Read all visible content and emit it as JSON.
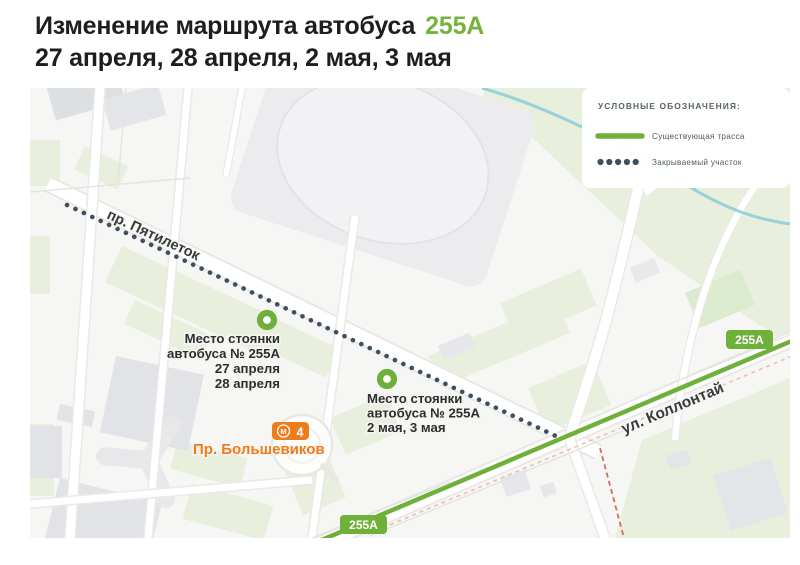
{
  "header": {
    "title_prefix": "Изменение маршрута автобуса",
    "title_route": "255А",
    "title_dates": "27 апреля, 28 апреля, 2 мая, 3 мая",
    "route_color": "#75b43c"
  },
  "legend": {
    "title": "УСЛОВНЫЕ ОБОЗНАЧЕНИЯ:",
    "items": [
      {
        "label": "Существующая трасса",
        "swatch": "solid-green-line",
        "color": "#6fb03a"
      },
      {
        "label": "Закрываемый участок",
        "swatch": "dotted-dark-line",
        "color": "#3e4e5e"
      }
    ]
  },
  "map": {
    "street_labels": [
      {
        "name": "пр. Пятилеток"
      },
      {
        "name": "ул. Коллонтай"
      }
    ],
    "route_badges": [
      {
        "label": "255А"
      },
      {
        "label": "255А"
      }
    ],
    "stops": [
      {
        "lines": [
          "Место стоянки",
          "автобуса № 255А",
          "27 апреля",
          "28 апреля"
        ]
      },
      {
        "lines": [
          "Место стоянки",
          "автобуса № 255А",
          "2 мая, 3 мая"
        ]
      }
    ],
    "metro": {
      "logo": "М",
      "line_number": "4",
      "station": "Пр. Большевиков",
      "color": "#ee7c1b"
    },
    "existing_route_color": "#6fb03a",
    "closed_segment_color": "#3f4f63"
  }
}
